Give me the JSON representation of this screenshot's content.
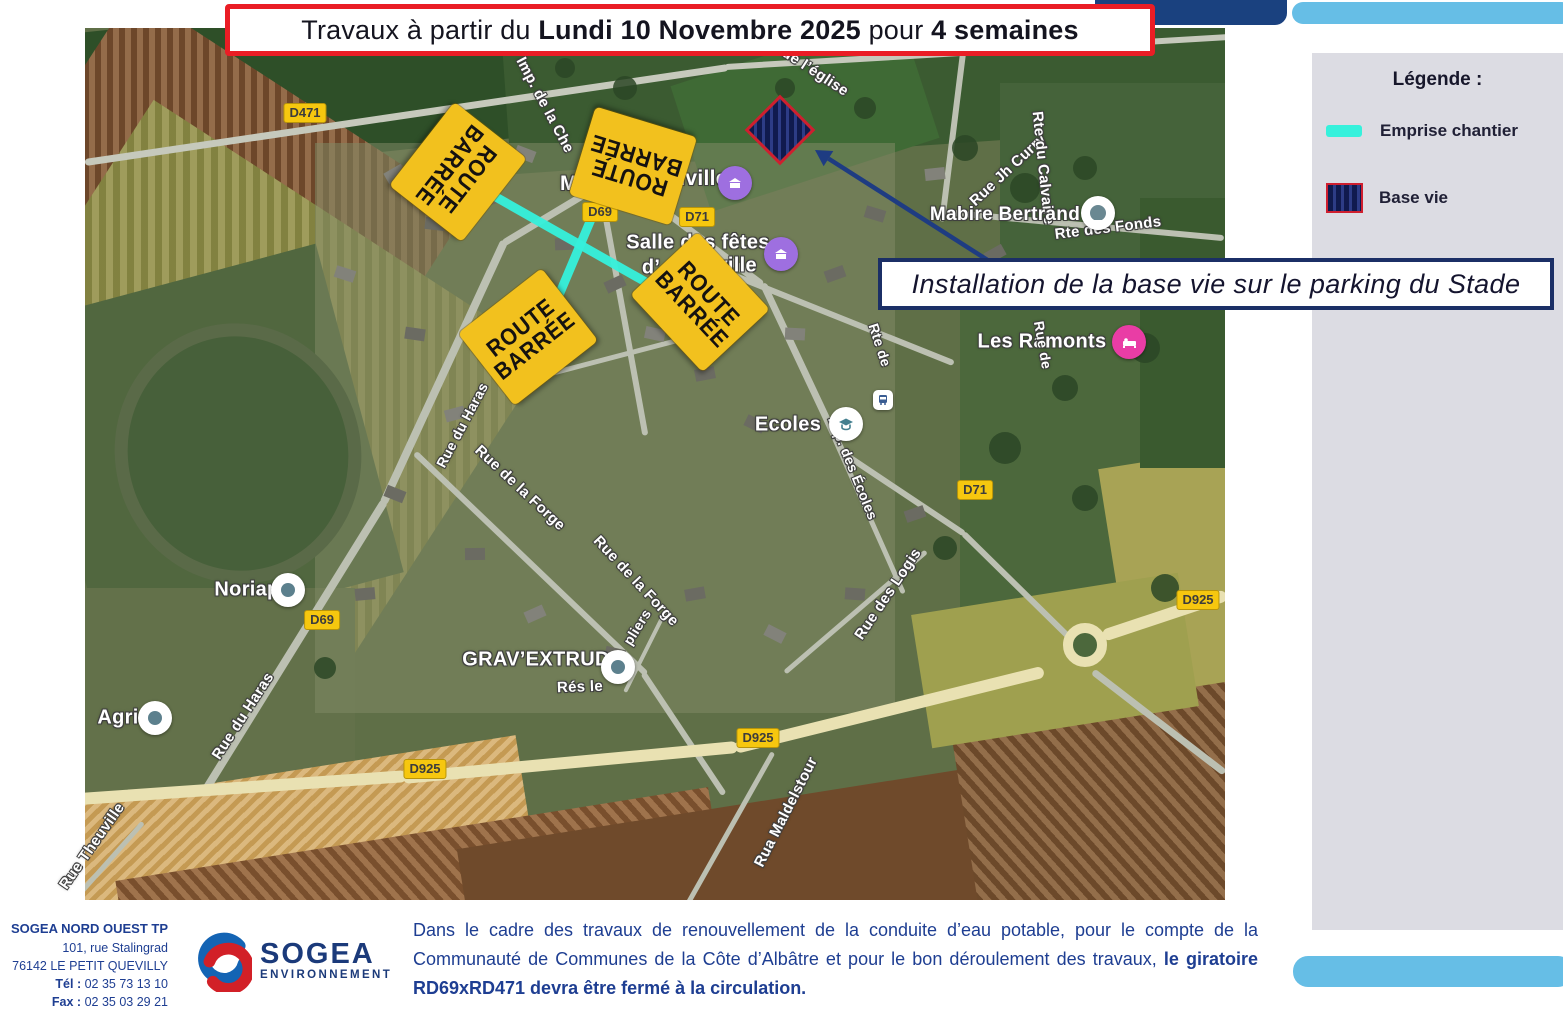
{
  "banner": {
    "part1": "Travaux à partir du ",
    "part2": "Lundi 10 Novembre 2025",
    "part3": " pour ",
    "part4": "4 semaines"
  },
  "legend": {
    "title": "Légende :",
    "items": [
      {
        "label": "Emprise chantier",
        "swatch": "cyan-line"
      },
      {
        "label": "Base vie",
        "swatch": "hatched-square"
      }
    ],
    "colors": {
      "emprise": "#36f1dc",
      "base_vie_fill": "#1c2864",
      "base_vie_border": "#cf1f2f"
    }
  },
  "callout": {
    "text": "Installation de la base vie sur le parking du Stade"
  },
  "map": {
    "signs": [
      {
        "line1": "ROUTE",
        "line2": "BARRÉE",
        "x": 458,
        "y": 172,
        "rot": 128
      },
      {
        "line1": "ROUTE",
        "line2": "BARRÉE",
        "x": 633,
        "y": 166,
        "rot": 197
      },
      {
        "line1": "ROUTE",
        "line2": "BARRÉE",
        "x": 528,
        "y": 337,
        "rot": -38
      },
      {
        "line1": "ROUTE",
        "line2": "BARRÉE",
        "x": 700,
        "y": 302,
        "rot": 47
      }
    ],
    "road_badges": [
      {
        "label": "D471",
        "x": 305,
        "y": 113
      },
      {
        "label": "D69",
        "x": 600,
        "y": 212
      },
      {
        "label": "D71",
        "x": 697,
        "y": 217
      },
      {
        "label": "D71",
        "x": 729,
        "y": 318
      },
      {
        "label": "D69",
        "x": 322,
        "y": 620
      },
      {
        "label": "D71",
        "x": 975,
        "y": 490
      },
      {
        "label": "D925",
        "x": 425,
        "y": 769
      },
      {
        "label": "D925",
        "x": 758,
        "y": 738
      },
      {
        "label": "D925",
        "x": 1198,
        "y": 600
      }
    ],
    "street_labels": [
      {
        "text": "Imp. de la Che",
        "x": 545,
        "y": 105,
        "rot": 62,
        "size": 15
      },
      {
        "text": "Imp. de l’église",
        "x": 800,
        "y": 62,
        "rot": 33,
        "size": 15
      },
      {
        "text": "Rue Jh Curry",
        "x": 1008,
        "y": 170,
        "rot": -43,
        "size": 15
      },
      {
        "text": "Rte du Calvaire",
        "x": 1043,
        "y": 168,
        "rot": 84,
        "size": 15
      },
      {
        "text": "Rte des Fonds",
        "x": 1108,
        "y": 228,
        "rot": -7,
        "size": 15
      },
      {
        "text": "Mabire Bertrand",
        "x": 1005,
        "y": 215,
        "rot": 0,
        "size": 19
      },
      {
        "text": "Mai",
        "x": 578,
        "y": 184,
        "rot": 0,
        "size": 21
      },
      {
        "text": "nville",
        "x": 700,
        "y": 179,
        "rot": 0,
        "size": 21
      },
      {
        "text": "Salle des fêtes",
        "x": 698,
        "y": 243,
        "rot": 0,
        "size": 20
      },
      {
        "text": "d’",
        "x": 651,
        "y": 268,
        "rot": 0,
        "size": 20
      },
      {
        "text": "éville",
        "x": 731,
        "y": 266,
        "rot": 0,
        "size": 20
      },
      {
        "text": "Les Ramonts",
        "x": 1042,
        "y": 342,
        "rot": 0,
        "size": 20
      },
      {
        "text": "Ecoles",
        "x": 788,
        "y": 425,
        "rot": 0,
        "size": 20
      },
      {
        "text": "Imp. des Écoles",
        "x": 853,
        "y": 468,
        "rot": 68,
        "size": 14
      },
      {
        "text": "Rue du Haras",
        "x": 462,
        "y": 425,
        "rot": -62,
        "size": 14
      },
      {
        "text": "Rue du Haras",
        "x": 243,
        "y": 716,
        "rot": -57,
        "size": 15
      },
      {
        "text": "Rue de la Forge",
        "x": 520,
        "y": 488,
        "rot": 43,
        "size": 15
      },
      {
        "text": "Rue de la Forge",
        "x": 636,
        "y": 581,
        "rot": 47,
        "size": 15
      },
      {
        "text": "pliers",
        "x": 637,
        "y": 627,
        "rot": -58,
        "size": 14
      },
      {
        "text": "GRAV’EXTRUD",
        "x": 536,
        "y": 660,
        "rot": 0,
        "size": 20
      },
      {
        "text": "Rés le",
        "x": 580,
        "y": 687,
        "rot": -2,
        "size": 15
      },
      {
        "text": "Rue des Logis",
        "x": 888,
        "y": 594,
        "rot": -56,
        "size": 15
      },
      {
        "text": "Rua Maldelstour",
        "x": 786,
        "y": 812,
        "rot": -63,
        "size": 15
      },
      {
        "text": "Rue Theuville",
        "x": 92,
        "y": 846,
        "rot": -55,
        "size": 15
      },
      {
        "text": "Rte de",
        "x": 880,
        "y": 345,
        "rot": 72,
        "size": 14
      },
      {
        "text": "Rue de",
        "x": 1043,
        "y": 345,
        "rot": 80,
        "size": 14
      },
      {
        "text": "Noriap",
        "x": 247,
        "y": 590,
        "rot": 0,
        "size": 20
      },
      {
        "text": "Agri",
        "x": 118,
        "y": 718,
        "rot": 0,
        "size": 20
      }
    ],
    "pois": [
      {
        "type": "mairie",
        "x": 735,
        "y": 183
      },
      {
        "type": "mairie",
        "x": 781,
        "y": 254
      },
      {
        "type": "school",
        "x": 846,
        "y": 424
      },
      {
        "type": "lodging",
        "x": 1129,
        "y": 342
      },
      {
        "type": "place",
        "x": 288,
        "y": 590
      },
      {
        "type": "place",
        "x": 155,
        "y": 718
      },
      {
        "type": "place",
        "x": 618,
        "y": 667
      },
      {
        "type": "business",
        "x": 1098,
        "y": 213
      },
      {
        "type": "bus",
        "x": 883,
        "y": 400
      }
    ],
    "emprise_lines": [
      {
        "x1": 480,
        "y1": 188,
        "x2": 665,
        "y2": 293
      },
      {
        "x1": 600,
        "y1": 198,
        "x2": 543,
        "y2": 333
      }
    ],
    "base_vie_marker": {
      "x": 780,
      "y": 130
    },
    "arrow": {
      "x1": 1000,
      "y1": 268,
      "x2": 815,
      "y2": 150
    }
  },
  "footer": {
    "company": {
      "name": "SOGEA NORD OUEST TP",
      "address1": "101, rue Stalingrad",
      "address2": "76142 LE PETIT QUEVILLY",
      "tel_label": "Tél :",
      "tel": " 02 35 73 13 10",
      "fax_label": "Fax :",
      "fax": " 02 35 03 29 21"
    },
    "logo": {
      "name": "SOGEA",
      "sub": "ENVIRONNEMENT"
    },
    "paragraph": {
      "normal": "Dans le cadre des travaux de renouvellement de la conduite d’eau potable, pour le compte de la Communauté de Communes de la Côte d’Albâtre et pour le bon déroulement des travaux, ",
      "bold": "le giratoire RD69xRD471 devra être fermé à la circulation."
    }
  }
}
